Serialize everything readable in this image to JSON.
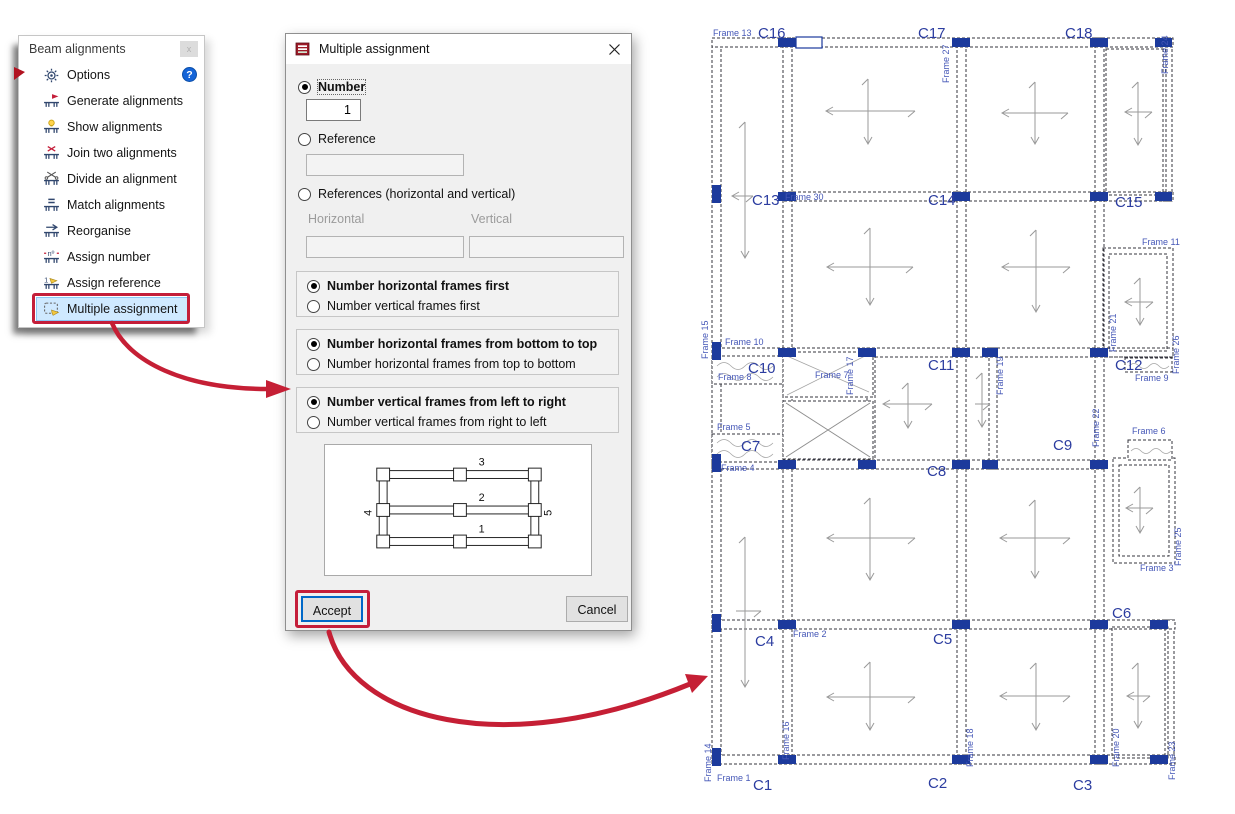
{
  "palette": {
    "red_accent": "#c41e3a",
    "menu_highlight_bg": "#cfe9ff",
    "menu_highlight_border": "#8cc6f4",
    "help_blue": "#1464d8",
    "dialog_bg": "#f0f0f0",
    "accept_focus_border": "#0068c8",
    "plan_column_blue": "#1c3a9c",
    "plan_label_blue": "#2c3da0",
    "plan_frame_label_blue": "#4557b7"
  },
  "icons": [
    "options-gear-icon",
    "generate-alignments-icon",
    "show-alignments-icon",
    "join-alignments-icon",
    "divide-alignment-icon",
    "match-alignments-icon",
    "reorganise-icon",
    "assign-number-icon",
    "assign-reference-icon",
    "multiple-assignment-icon",
    "help-icon",
    "close-icon",
    "dialog-app-icon",
    "red-flag-pointer",
    "curved-arrow"
  ],
  "menu": {
    "title": "Beam alignments",
    "close_glyph": "x",
    "help_glyph": "?",
    "items": [
      {
        "label": "Options"
      },
      {
        "label": "Generate alignments"
      },
      {
        "label": "Show alignments"
      },
      {
        "label": "Join two alignments"
      },
      {
        "label": "Divide an alignment"
      },
      {
        "label": "Match alignments"
      },
      {
        "label": "Reorganise"
      },
      {
        "label": "Assign number"
      },
      {
        "label": "Assign reference"
      },
      {
        "label": "Multiple assignment",
        "highlighted": true
      }
    ]
  },
  "dialog": {
    "title": "Multiple assignment",
    "options": {
      "number_label": "Number",
      "number_value": "1",
      "reference_label": "Reference",
      "references_label": "References (horizontal and vertical)",
      "horizontal_label": "Horizontal",
      "vertical_label": "Vertical"
    },
    "groups": [
      {
        "options": [
          "Number horizontal frames first",
          "Number vertical frames first"
        ],
        "selected_index": 0
      },
      {
        "options": [
          "Number horizontal frames from bottom to top",
          "Number horizontal frames from top to bottom"
        ],
        "selected_index": 0
      },
      {
        "options": [
          "Number vertical frames from left to right",
          "Number vertical frames from right to left"
        ],
        "selected_index": 0
      }
    ],
    "preview_labels": {
      "h1": "1",
      "h2": "2",
      "h3": "3",
      "v_left": "4",
      "v_right": "5"
    },
    "accept_label": "Accept",
    "cancel_label": "Cancel"
  },
  "plan": {
    "labels": [
      {
        "t": "C16",
        "x": 63,
        "y": 28,
        "cls": "c"
      },
      {
        "t": "C17",
        "x": 223,
        "y": 28,
        "cls": "c"
      },
      {
        "t": "C18",
        "x": 370,
        "y": 28,
        "cls": "c"
      },
      {
        "t": "C13",
        "x": 57,
        "y": 195,
        "cls": "c"
      },
      {
        "t": "C14",
        "x": 233,
        "y": 195,
        "cls": "c"
      },
      {
        "t": "C15",
        "x": 420,
        "y": 197,
        "cls": "c"
      },
      {
        "t": "C10",
        "x": 53,
        "y": 363,
        "cls": "c"
      },
      {
        "t": "C11",
        "x": 233,
        "y": 360,
        "cls": "c"
      },
      {
        "t": "C12",
        "x": 420,
        "y": 360,
        "cls": "c"
      },
      {
        "t": "C7",
        "x": 46,
        "y": 441,
        "cls": "c"
      },
      {
        "t": "C8",
        "x": 232,
        "y": 466,
        "cls": "c"
      },
      {
        "t": "C9",
        "x": 358,
        "y": 440,
        "cls": "c"
      },
      {
        "t": "C4",
        "x": 60,
        "y": 636,
        "cls": "c"
      },
      {
        "t": "C5",
        "x": 238,
        "y": 634,
        "cls": "c"
      },
      {
        "t": "C6",
        "x": 417,
        "y": 608,
        "cls": "c"
      },
      {
        "t": "C1",
        "x": 58,
        "y": 780,
        "cls": "c"
      },
      {
        "t": "C2",
        "x": 233,
        "y": 778,
        "cls": "c"
      },
      {
        "t": "C3",
        "x": 378,
        "y": 780,
        "cls": "c"
      },
      {
        "t": "Frame 13",
        "x": 18,
        "y": 26,
        "cls": "f"
      },
      {
        "t": "Frame 27",
        "x": 254,
        "y": 73,
        "cls": "f",
        "rot": true
      },
      {
        "t": "Frame 24",
        "x": 473,
        "y": 64,
        "cls": "f",
        "rot": true
      },
      {
        "t": "Frame 30",
        "x": 90,
        "y": 190,
        "cls": "f"
      },
      {
        "t": "Frame 11",
        "x": 447,
        "y": 235,
        "cls": "f"
      },
      {
        "t": "Frame 15",
        "x": 13,
        "y": 349,
        "cls": "f",
        "rot": true
      },
      {
        "t": "Frame 10",
        "x": 30,
        "y": 335,
        "cls": "f"
      },
      {
        "t": "Frame 8",
        "x": 23,
        "y": 370,
        "cls": "f"
      },
      {
        "t": "Frame 7",
        "x": 120,
        "y": 368,
        "cls": "f"
      },
      {
        "t": "Frame 17",
        "x": 158,
        "y": 385,
        "cls": "f",
        "rot": true
      },
      {
        "t": "Frame 19",
        "x": 308,
        "y": 385,
        "cls": "f",
        "rot": true
      },
      {
        "t": "Frame 21",
        "x": 421,
        "y": 342,
        "cls": "f",
        "rot": true
      },
      {
        "t": "Frame 26",
        "x": 484,
        "y": 364,
        "cls": "f",
        "rot": true
      },
      {
        "t": "Frame 9",
        "x": 440,
        "y": 371,
        "cls": "f"
      },
      {
        "t": "Frame 22",
        "x": 404,
        "y": 437,
        "cls": "f",
        "rot": true
      },
      {
        "t": "Frame 6",
        "x": 437,
        "y": 424,
        "cls": "f"
      },
      {
        "t": "Frame 25",
        "x": 486,
        "y": 556,
        "cls": "f",
        "rot": true
      },
      {
        "t": "Frame 5",
        "x": 22,
        "y": 420,
        "cls": "f"
      },
      {
        "t": "Frame 4",
        "x": 26,
        "y": 461,
        "cls": "f"
      },
      {
        "t": "Frame 3",
        "x": 445,
        "y": 561,
        "cls": "f"
      },
      {
        "t": "Frame 2",
        "x": 98,
        "y": 627,
        "cls": "f"
      },
      {
        "t": "Frame 14",
        "x": 16,
        "y": 772,
        "cls": "f",
        "rot": true
      },
      {
        "t": "Frame 16",
        "x": 94,
        "y": 750,
        "cls": "f",
        "rot": true
      },
      {
        "t": "Frame 18",
        "x": 278,
        "y": 757,
        "cls": "f",
        "rot": true
      },
      {
        "t": "Frame 20",
        "x": 424,
        "y": 757,
        "cls": "f",
        "rot": true
      },
      {
        "t": "Frame 23",
        "x": 480,
        "y": 770,
        "cls": "f",
        "rot": true
      },
      {
        "t": "Frame 1",
        "x": 22,
        "y": 771,
        "cls": "f"
      }
    ]
  }
}
